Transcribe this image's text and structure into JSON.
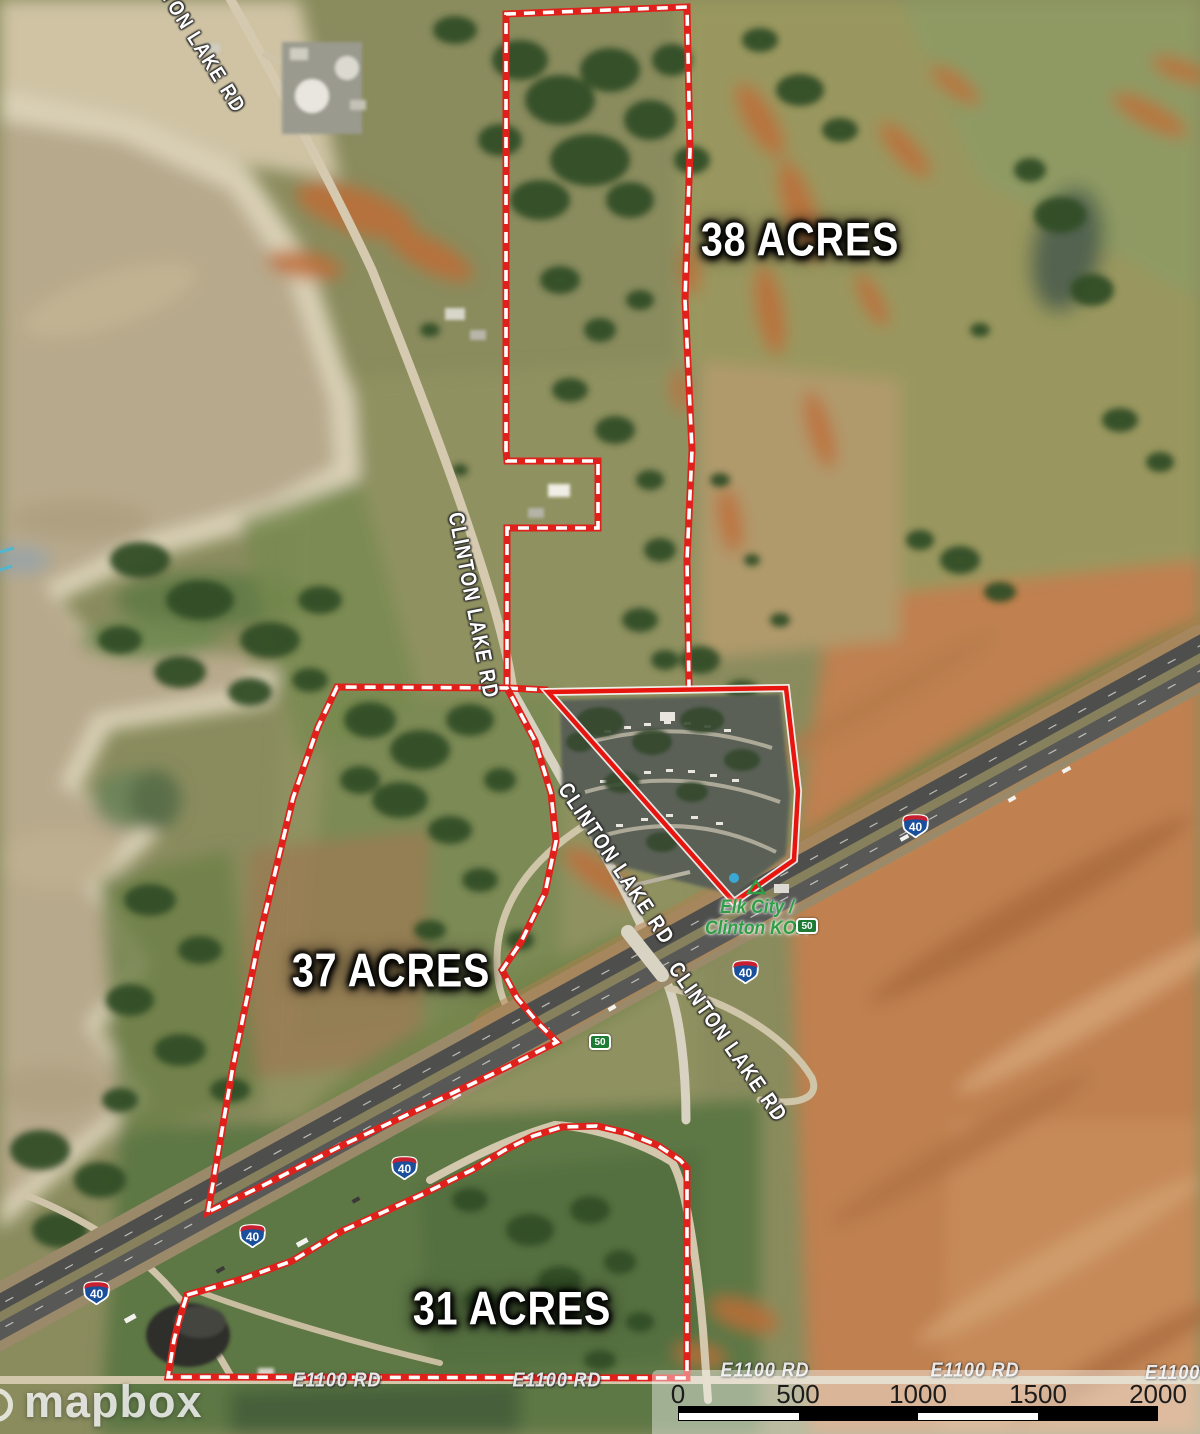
{
  "map_type": "satellite-parcel-map",
  "parcels": {
    "p38": {
      "label": "38 ACRES"
    },
    "p37": {
      "label": "37 ACRES"
    },
    "p31": {
      "label": "31 ACRES"
    }
  },
  "roads": {
    "clinton_lake_rd": "CLINTON LAKE RD",
    "e1100_rd": "E1100 RD"
  },
  "shields": {
    "interstate_40": "40",
    "highway_50": "50"
  },
  "poi": {
    "koa_line1": "Elk City /",
    "koa_line2": "Clinton KOA"
  },
  "scale_bar": {
    "ticks": [
      "0",
      "500",
      "1000",
      "1500",
      "2000"
    ]
  },
  "attribution": {
    "logo": "mapbox"
  },
  "colors": {
    "parcel_outline_red": "#e0201b",
    "parcel_dash_white": "#ffffff",
    "koa_label_green": "#2f9e44",
    "interstate_blue": "#1a4f9c",
    "interstate_red": "#c8202f",
    "highway50_green": "#1e7b33",
    "water_tan": "#b7a98b",
    "red_dirt": "#c07a45"
  }
}
